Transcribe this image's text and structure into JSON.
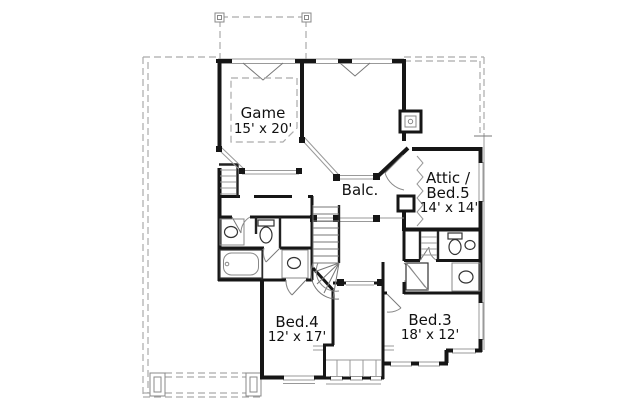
{
  "plan": {
    "title": "Second floor plan",
    "rooms": {
      "game": {
        "name": "Game",
        "dims": "15' x 20'"
      },
      "balcony": {
        "name": "Balc."
      },
      "attic_bed5": {
        "name_line1": "Attic /",
        "name_line2": "Bed.5",
        "dims": "14' x 14'"
      },
      "bed4": {
        "name": "Bed.4",
        "dims": "12' x 17'"
      },
      "bed3": {
        "name": "Bed.3",
        "dims": "18' x 12'"
      }
    },
    "colors": {
      "wall": "#161616",
      "thin_line": "#999999",
      "roof_dash": "#aaaaaa",
      "text": "#111111",
      "background": "#ffffff"
    }
  }
}
